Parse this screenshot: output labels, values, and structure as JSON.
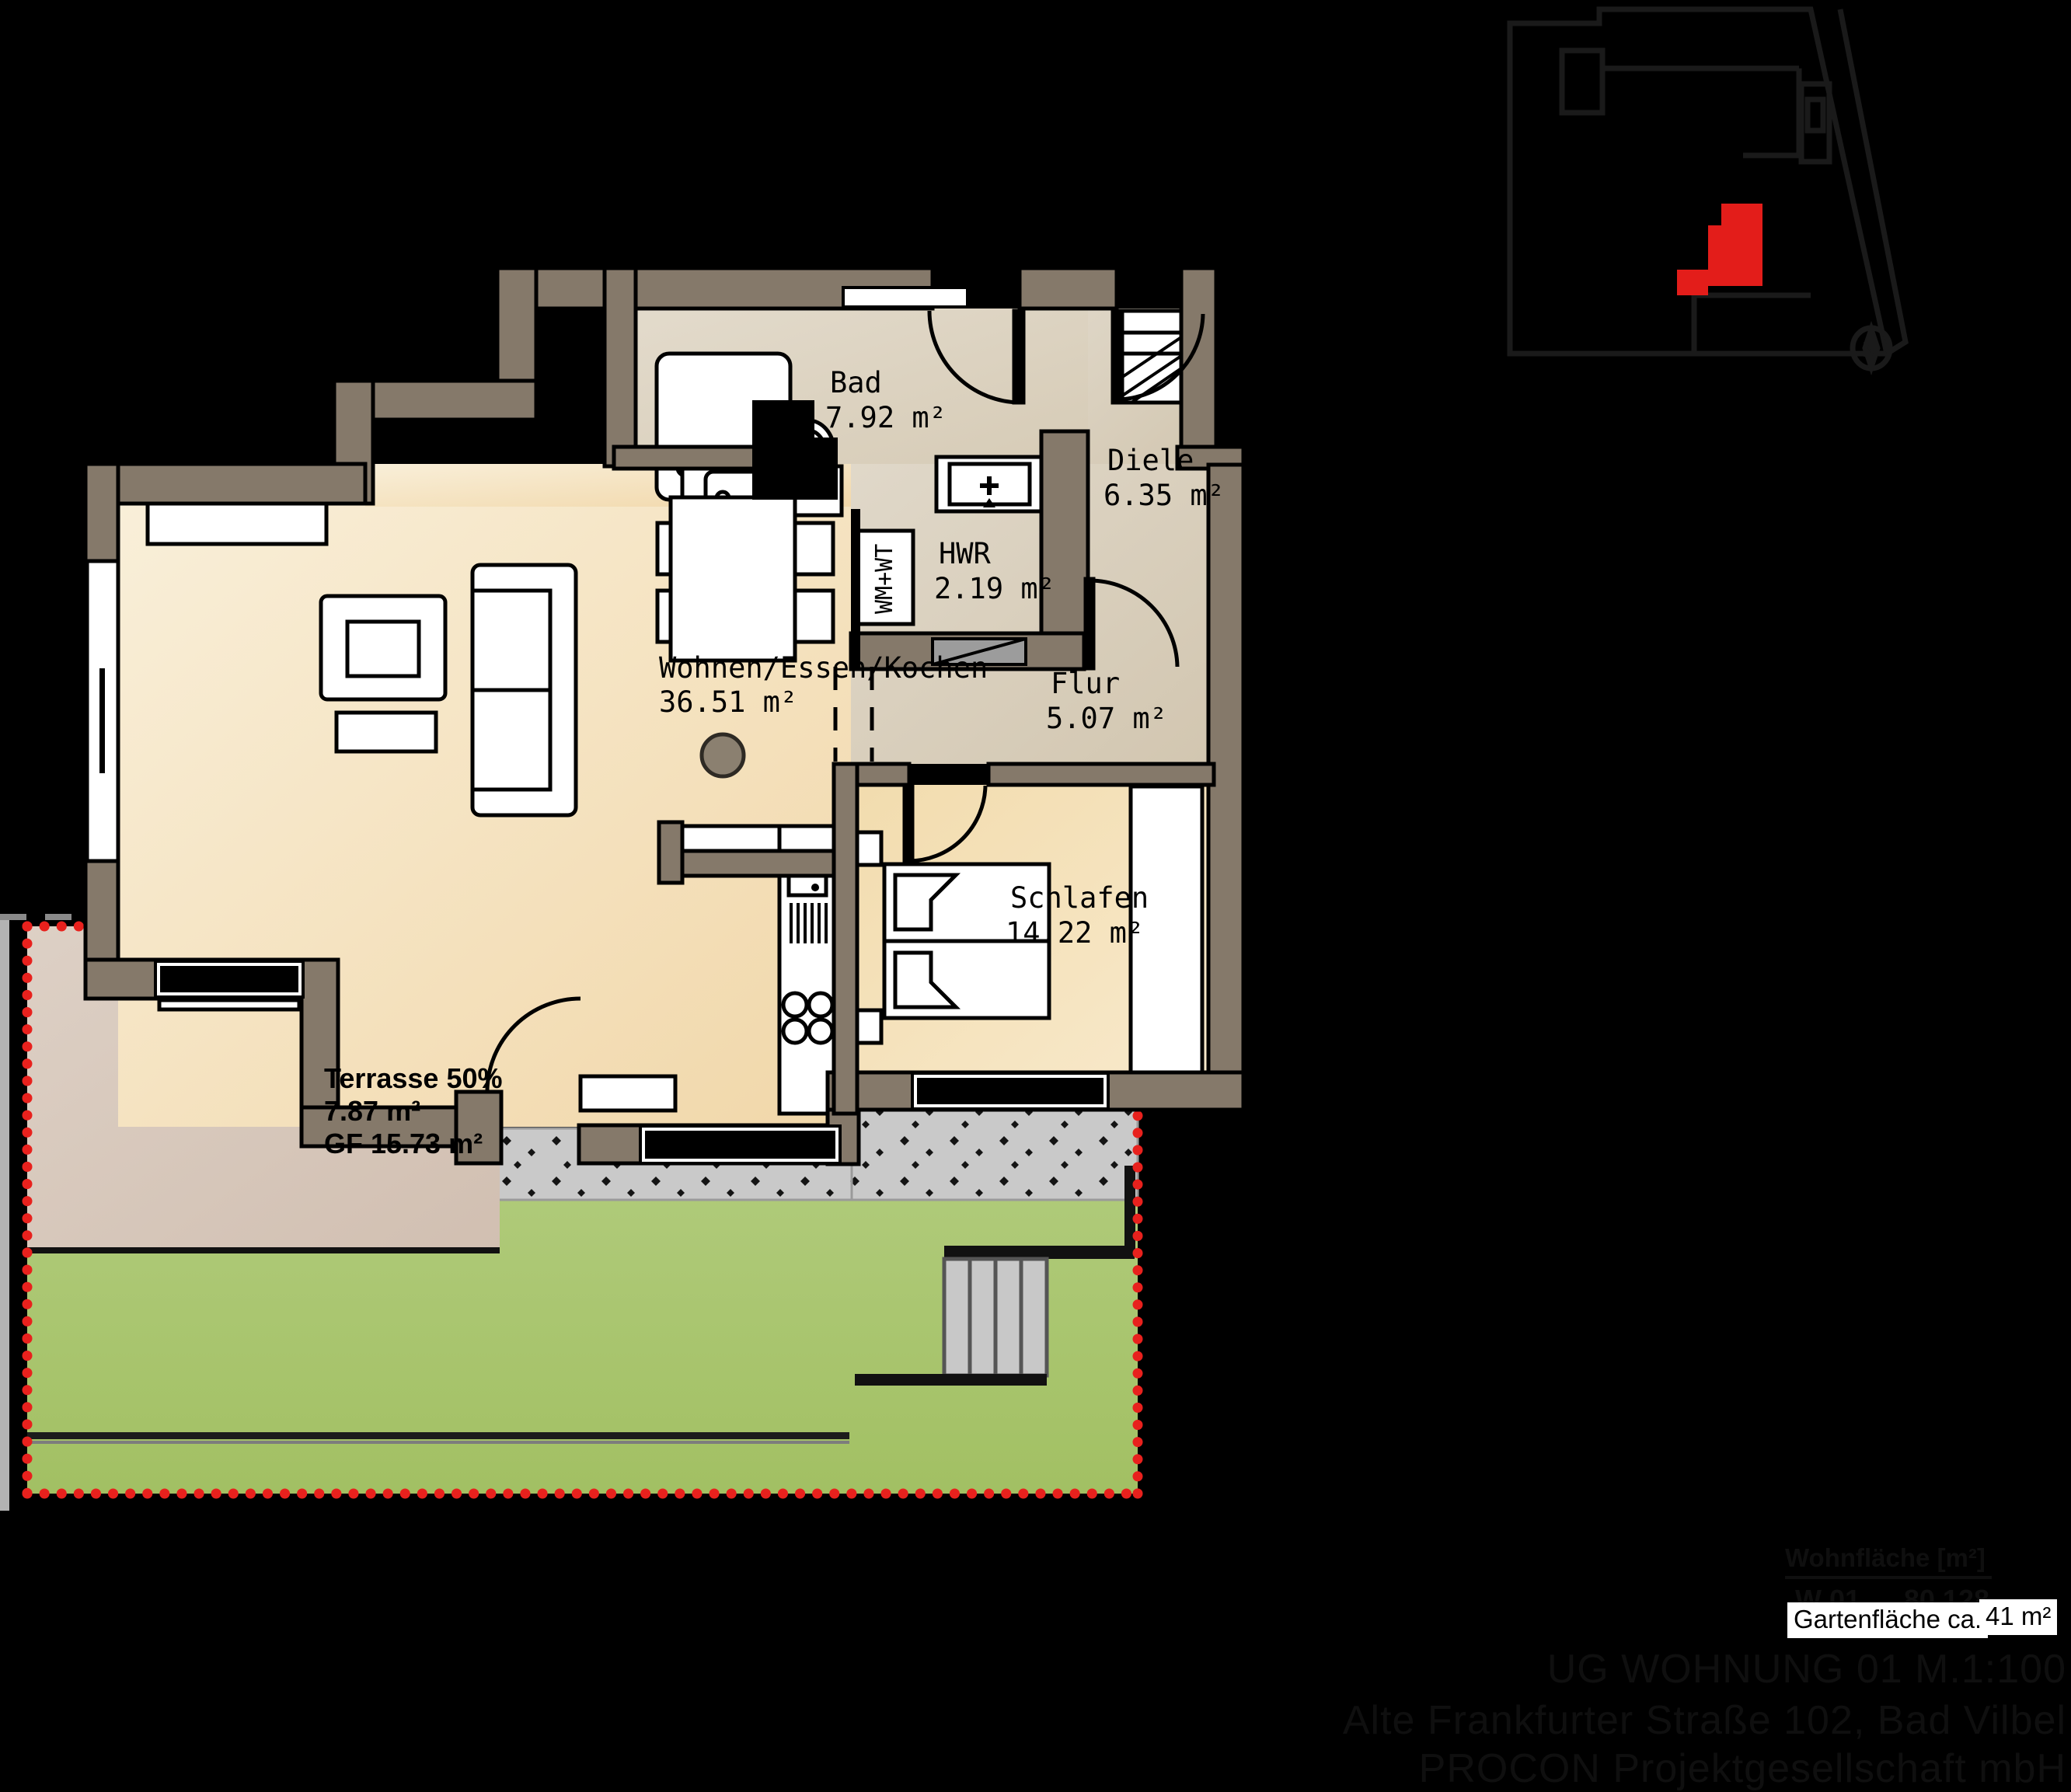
{
  "plan": {
    "rooms": {
      "bad": {
        "name": "Bad",
        "area": "7.92 m²"
      },
      "diele": {
        "name": "Diele",
        "area": "6.35 m²"
      },
      "hwr": {
        "name": "HWR",
        "area": "2.19 m²"
      },
      "flur": {
        "name": "Flur",
        "area": "5.07 m²"
      },
      "wohnen": {
        "name": "Wohnen/Essen/Kochen",
        "area": "36.51 m²"
      },
      "schlafen": {
        "name": "Schlafen",
        "area": "14.22 m²"
      },
      "terrasse": {
        "line1": "Terrasse 50%",
        "line2": "7.87 m²",
        "line3": "GF 15.73 m²"
      },
      "washer_label": "WM+WT"
    },
    "compass_label": "N"
  },
  "legend": {
    "header": "Wohnfläche [m²]",
    "unit_label": "W 01",
    "unit_value": "80,128",
    "garden_label": "Gartenfläche ca.",
    "garden_value": "41 m²"
  },
  "footer": {
    "line1": "UG WOHNUNG 01 M.1:100",
    "line2": "Alte Frankfurter Straße 102, Bad Vilbel",
    "line3": "PROCON Projektgesellschaft mbH"
  },
  "colors": {
    "wall": "#85796a",
    "floor_living": "#f5e3c0",
    "floor_hall": "#d9cfbd",
    "terrace": "#d8cabe",
    "grass": "#a8c56f",
    "gravel": "#c9c9c9",
    "boundary_red": "#e8211d",
    "minimap_unit_red": "#e31d1a",
    "hidden_text": "#0f0f0f"
  }
}
